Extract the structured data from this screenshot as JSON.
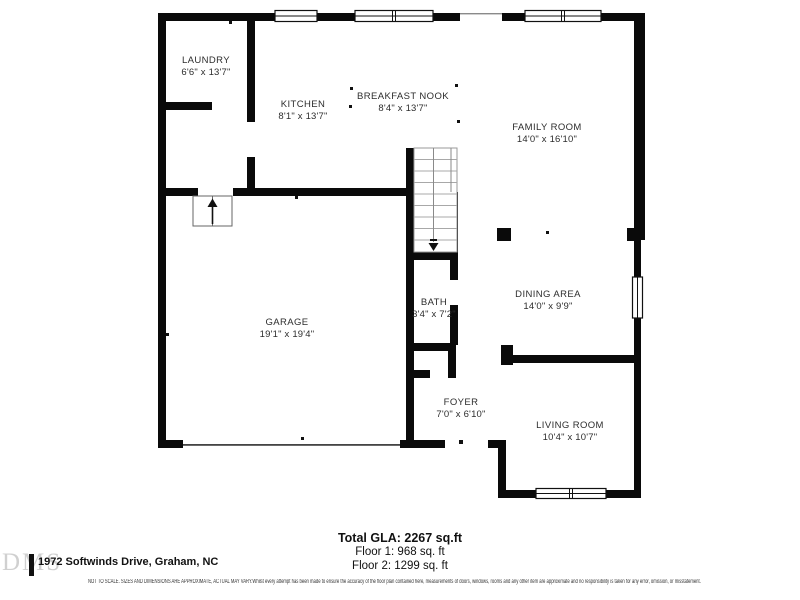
{
  "rooms": [
    {
      "name": "LAUNDRY",
      "dims": "6'6\" x 13'7\""
    },
    {
      "name": "KITCHEN",
      "dims": "8'1\" x 13'7\""
    },
    {
      "name": "BREAKFAST NOOK",
      "dims": "8'4\" x 13'7\""
    },
    {
      "name": "FAMILY ROOM",
      "dims": "14'0\" x 16'10\""
    },
    {
      "name": "GARAGE",
      "dims": "19'1\" x 19'4\""
    },
    {
      "name": "BATH",
      "dims": "3'4\" x 7'2\""
    },
    {
      "name": "DINING AREA",
      "dims": "14'0\" x 9'9\""
    },
    {
      "name": "FOYER",
      "dims": "7'0\" x 6'10\""
    },
    {
      "name": "LIVING ROOM",
      "dims": "10'4\" x 10'7\""
    }
  ],
  "summary": {
    "total": "Total GLA: 2267 sq.ft",
    "floor1": "Floor 1: 968 sq. ft",
    "floor2": "Floor 2: 1299 sq. ft"
  },
  "footer": {
    "logo": "DMS",
    "address": "1972 Softwinds Drive, Graham, NC",
    "disclaimer": "NOT TO SCALE. SIZES AND DIMENSIONS ARE APPROXIMATE, ACTUAL MAY VARY.Whilst every attempt has been made to ensure the accuracy of the floor plan contained here, measurements of doors, windows, rooms and any other item are approximate and no responsibility is taken for any error, omission, or misstatement."
  },
  "colors": {
    "wall": "#0a0a0a",
    "background": "#ffffff",
    "stair_tread": "#a8a8a8"
  }
}
